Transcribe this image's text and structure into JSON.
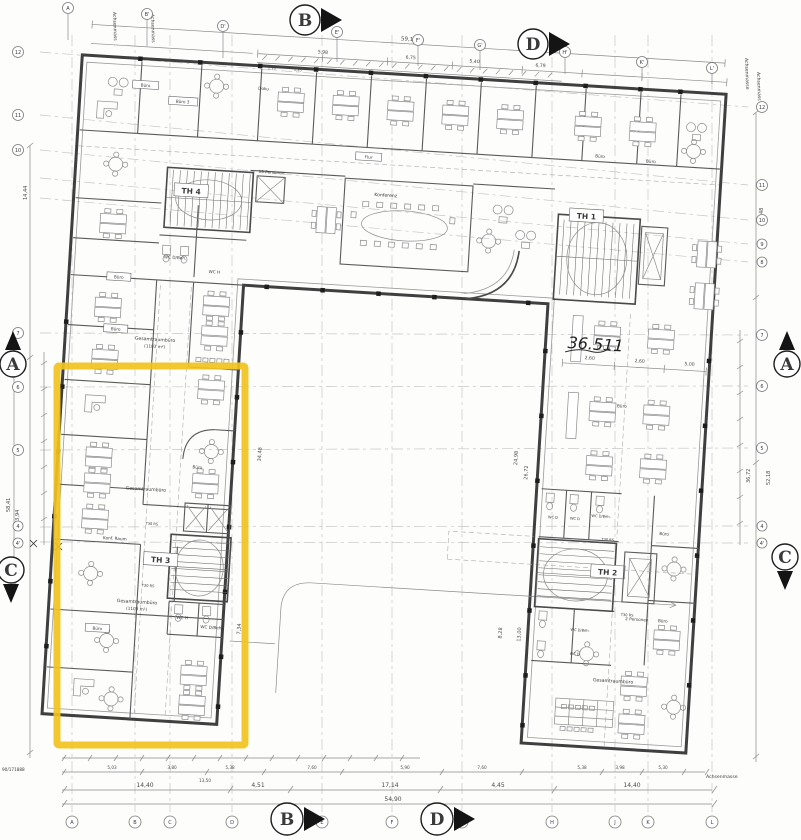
{
  "grid": {
    "sections": {
      "a": "A",
      "b": "B",
      "c": "C",
      "d": "D"
    },
    "top": [
      "A",
      "B'",
      "D'",
      "E'",
      "F'",
      "G'",
      "H'",
      "K'",
      "L'"
    ],
    "bottom": [
      "A",
      "B",
      "C",
      "D",
      "E",
      "F",
      "G",
      "H",
      "J",
      "K",
      "L"
    ],
    "left": [
      "12",
      "11",
      "10",
      "7",
      "6",
      "5",
      "4",
      "4'"
    ],
    "right": [
      "12",
      "11",
      "10",
      "9",
      "8",
      "7",
      "6",
      "5",
      "4",
      "4'"
    ]
  },
  "stairwells": {
    "th1": "TH 1",
    "th2": "TH 2",
    "th3": "TH 3",
    "th4": "TH 4"
  },
  "rooms": {
    "buero": "Büro",
    "buero3": "Büro 3",
    "doku": "Doku",
    "konferenz": "Konferenz",
    "flur": "Flur",
    "konf_raum": "Konf. Raum",
    "gesamtraumbuero": "Gesamtraumbüro",
    "area_1103": "(1103 m²)",
    "wc_h": "WC H",
    "wc_d": "WC D",
    "wc_d_beh": "WC D/Beh.",
    "lift13": "13 Personen",
    "lift2": "2 Personen",
    "t30": "T30 RS"
  },
  "dimensions": {
    "top_total": "59,19",
    "top_segments": [
      "5,98",
      "6,75",
      "5,40",
      "6,79"
    ],
    "tick": "1,35",
    "bottom_main": [
      "14,40",
      "4,51",
      "17,14",
      "4,45",
      "14,40"
    ],
    "bottom_mid": "13,50",
    "bottom_total": "54,90",
    "bottom_segments": [
      "5,03",
      "3,80",
      "5,38",
      "7,60",
      "5,90",
      "7,60",
      "5,38",
      "3,98",
      "5,30"
    ],
    "left": [
      "14,44",
      "58,41",
      "43,94"
    ],
    "right": [
      "14,48",
      "36,72",
      "52,18"
    ],
    "courtyard": [
      "34,48",
      "24,98",
      "26,72",
      "8,28",
      "13,00",
      "7,34"
    ],
    "interior": [
      "2,60",
      "2,60",
      "5,00"
    ]
  },
  "annotations": {
    "achsenmass": "Achsenmass",
    "achsenmasse": "Achsenmasse",
    "plan_number": "90/171888",
    "scribble": "36.511"
  },
  "highlight": {
    "color": "#f2c21e"
  }
}
